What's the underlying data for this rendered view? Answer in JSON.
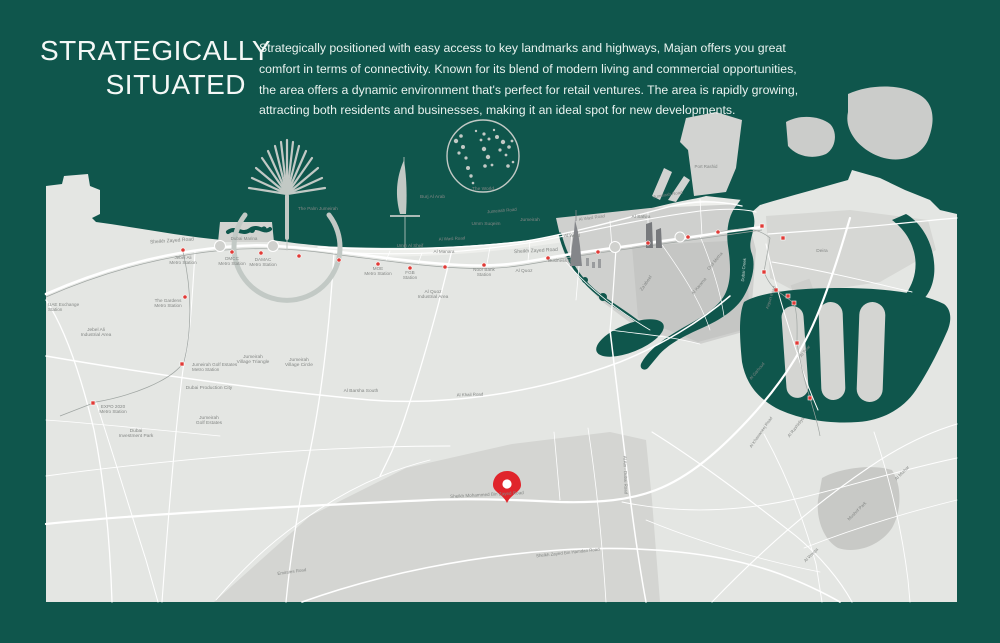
{
  "page": {
    "background": "#0F564C"
  },
  "header": {
    "title_line1": "STRATEGICALLY",
    "title_line2": "SITUATED",
    "paragraph_lines": [
      "Strategically positioned with easy access to key landmarks and highways, Majan offers you great",
      "comfort in terms of connectivity. Known for its blend of modern living and commercial opportunities,",
      "the area offers a dynamic environment that's perfect for retail ventures. The area is rapidly growing,",
      "attracting both residents and businesses, making it an ideal spot for new developments."
    ]
  },
  "map": {
    "colors": {
      "water": "#0F564C",
      "land": "#E4E6E3",
      "land_light": "#EEEFEC",
      "district": "#CFD0CE",
      "district_dark": "#C5C6C4",
      "mid_band": "#D4D5D2",
      "road": "#FFFFFF",
      "label": "#848785",
      "label_on_water": "#CBD8D4",
      "metro_line": "#9FA5A2",
      "metro_station": "#E03A36",
      "pin": "#E0242B",
      "icon": "#C2C9C5",
      "towers": "#84868A"
    },
    "icons": {
      "palm": "palm-jumeirah-icon",
      "sail": "burj-al-arab-icon",
      "globe": "the-world-icon",
      "pin": "location-pin-icon"
    },
    "metro": {
      "dots": [
        [
          183,
          250
        ],
        [
          232,
          252
        ],
        [
          261,
          253
        ],
        [
          299,
          256
        ],
        [
          339,
          260
        ],
        [
          378,
          264
        ],
        [
          410,
          268
        ],
        [
          445,
          267
        ],
        [
          484,
          265
        ],
        [
          548,
          258
        ],
        [
          598,
          252
        ],
        [
          648,
          243
        ],
        [
          688,
          237
        ],
        [
          718,
          232
        ],
        [
          185,
          297
        ]
      ],
      "squares": [
        [
          93,
          403
        ],
        [
          182,
          364
        ],
        [
          762,
          226
        ],
        [
          783,
          238
        ],
        [
          764,
          272
        ],
        [
          776,
          290
        ],
        [
          788,
          296
        ],
        [
          794,
          303
        ],
        [
          797,
          343
        ],
        [
          810,
          398
        ]
      ]
    },
    "labels": [
      {
        "t": "Sheikh Zayed Road",
        "x": 172,
        "y": 242,
        "s": 5,
        "r": -4
      },
      {
        "t": "Jebel Ali",
        "t2": "Metro Station",
        "x": 183,
        "y": 259,
        "s": 4.6
      },
      {
        "t": "DMCC",
        "t2": "Metro Station",
        "x": 232,
        "y": 260,
        "s": 4.6
      },
      {
        "t": "DAMAC",
        "t2": "Metro Station",
        "x": 263,
        "y": 261,
        "s": 4.6
      },
      {
        "t": "Dubai Marina",
        "x": 244,
        "y": 240,
        "s": 4.5
      },
      {
        "t": "The Palm Jumeirah",
        "x": 298,
        "y": 210,
        "s": 4.6,
        "a": "s"
      },
      {
        "t": "Burj Al Arab",
        "x": 420,
        "y": 198,
        "s": 4.8,
        "a": "s"
      },
      {
        "t": "The World",
        "x": 483,
        "y": 190,
        "s": 4.8
      },
      {
        "t": "UAE Exchange",
        "t2": "Station",
        "x": 48,
        "y": 306,
        "s": 4.6,
        "a": "s"
      },
      {
        "t": "The Gardens",
        "t2": "Metro Station",
        "x": 168,
        "y": 302,
        "s": 4.6
      },
      {
        "t": "Jebel Ali",
        "t2": "Industrial Area",
        "x": 96,
        "y": 331,
        "s": 4.8
      },
      {
        "t": "EXPO 2020",
        "t2": "Metro Station",
        "x": 113,
        "y": 408,
        "s": 4.6
      },
      {
        "t": "Dubai",
        "t2": "Investment Park",
        "x": 136,
        "y": 432,
        "s": 4.8
      },
      {
        "t": "Jumeirah Golf Estates",
        "t2": "Metro Station",
        "x": 192,
        "y": 366,
        "s": 4.6,
        "a": "s"
      },
      {
        "t": "Jumeirah",
        "t2": "Village Triangle",
        "x": 253,
        "y": 358,
        "s": 4.8
      },
      {
        "t": "Jumeirah",
        "t2": "Village Circle",
        "x": 299,
        "y": 361,
        "s": 4.8
      },
      {
        "t": "Dubai Production City",
        "x": 209,
        "y": 389,
        "s": 4.8
      },
      {
        "t": "Jumeirah",
        "t2": "Golf Estates",
        "x": 209,
        "y": 419,
        "s": 4.8
      },
      {
        "t": "Al Barsha South",
        "x": 361,
        "y": 392,
        "s": 4.8
      },
      {
        "t": "Al Quoz",
        "t2": "Industrial Area",
        "x": 433,
        "y": 293,
        "s": 4.8
      },
      {
        "t": "Al Quoz",
        "x": 524,
        "y": 272,
        "s": 4.8
      },
      {
        "t": "MOE",
        "t2": "Metro Station",
        "x": 378,
        "y": 270,
        "s": 4.6
      },
      {
        "t": "FGB",
        "t2": "Station",
        "x": 410,
        "y": 274,
        "s": 4.6
      },
      {
        "t": "Noor Bank",
        "t2": "Station",
        "x": 484,
        "y": 271,
        "s": 4.6
      },
      {
        "t": "Business Bay",
        "x": 562,
        "y": 262,
        "s": 4.6
      },
      {
        "t": "Sheikh Zayed Road",
        "x": 536,
        "y": 252,
        "s": 5,
        "r": -3
      },
      {
        "t": "Umm Al Sheif",
        "x": 410,
        "y": 247,
        "s": 4.4
      },
      {
        "t": "Al Manara",
        "x": 444,
        "y": 253,
        "s": 4.6
      },
      {
        "t": "Umm Suqeim",
        "x": 486,
        "y": 225,
        "s": 4.8
      },
      {
        "t": "Al Wasl Road",
        "x": 452,
        "y": 240,
        "s": 4.4,
        "r": -3
      },
      {
        "t": "Jumeirah Road",
        "x": 502,
        "y": 212,
        "s": 4.4,
        "r": -5
      },
      {
        "t": "Jumeirah",
        "x": 530,
        "y": 221,
        "s": 4.8
      },
      {
        "t": "Al Wasl",
        "x": 572,
        "y": 237,
        "s": 4.8
      },
      {
        "t": "Al Wasl Road",
        "x": 592,
        "y": 219,
        "s": 4.4,
        "r": -8
      },
      {
        "t": "Jumeirah Road",
        "x": 668,
        "y": 196,
        "s": 4.4,
        "r": -9
      },
      {
        "t": "Al Satwa",
        "x": 641,
        "y": 218,
        "s": 4.8
      },
      {
        "t": "Za'abeel",
        "x": 647,
        "y": 284,
        "s": 4.6,
        "r": -55
      },
      {
        "t": "Oud Metha",
        "x": 716,
        "y": 262,
        "s": 4.4,
        "r": -50
      },
      {
        "t": "Al Karama",
        "x": 700,
        "y": 287,
        "s": 4.4,
        "r": -50
      },
      {
        "t": "Port Rashid",
        "x": 706,
        "y": 168,
        "s": 4.4
      },
      {
        "t": "Deira",
        "x": 822,
        "y": 252,
        "s": 4.8
      },
      {
        "t": "Dubai Creek",
        "x": 745,
        "y": 270,
        "s": 4.2,
        "r": -85,
        "c": "#CBD8D4"
      },
      {
        "t": "Airport Road",
        "x": 772,
        "y": 298,
        "s": 4.2,
        "r": -72
      },
      {
        "t": "Al Twar",
        "x": 806,
        "y": 352,
        "s": 4.2,
        "r": -50
      },
      {
        "t": "Al Garhoud",
        "x": 758,
        "y": 372,
        "s": 4.2,
        "r": -50
      },
      {
        "t": "Al Rashidiya",
        "x": 797,
        "y": 428,
        "s": 4.4,
        "r": -52
      },
      {
        "t": "Al Khawaneej Road",
        "x": 762,
        "y": 433,
        "s": 4.2,
        "r": -55
      },
      {
        "t": "Mushrif Park",
        "x": 858,
        "y": 512,
        "s": 4.4,
        "r": -45
      },
      {
        "t": "Al Mizhar",
        "x": 903,
        "y": 474,
        "s": 4.4,
        "r": -45
      },
      {
        "t": "Al Warqa",
        "x": 812,
        "y": 556,
        "s": 4.4,
        "r": -45
      },
      {
        "t": "Al Khail Road",
        "x": 470,
        "y": 396,
        "s": 4.4,
        "r": -2
      },
      {
        "t": "Emirates Road",
        "x": 292,
        "y": 573,
        "s": 4.4,
        "r": -8
      },
      {
        "t": "Sheikh Mohammed Bin Zayed Road",
        "x": 487,
        "y": 496,
        "s": 4.6,
        "r": -3
      },
      {
        "t": "Sheikh Zayed Bin Hamdan Road",
        "x": 568,
        "y": 554,
        "s": 4.4,
        "r": -6
      },
      {
        "t": "Al Ain - Dubai Road",
        "x": 624,
        "y": 475,
        "s": 4.4,
        "r": 88
      }
    ]
  }
}
